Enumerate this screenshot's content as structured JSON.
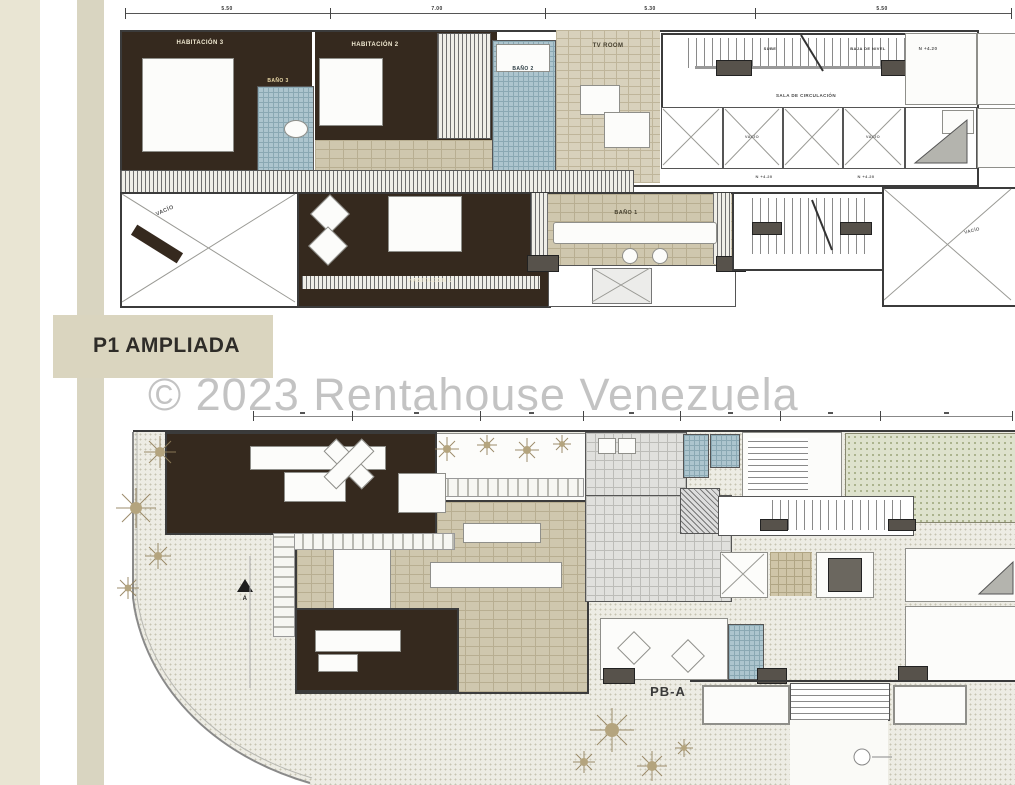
{
  "watermark": {
    "text": "© 2023 Rentahouse Venezuela"
  },
  "plan1": {
    "title": "P1 AMPLIADA",
    "dims": [
      "5.50",
      "7.00",
      "5.30",
      "5.50"
    ],
    "rooms": {
      "habitacion3": "HABITACIÓN 3",
      "bano3": "BAÑO 3",
      "habitacion2": "HABITACIÓN 2",
      "bano2": "BAÑO 2",
      "tvroom": "TV ROOM",
      "habitacion1": "HABITACIÓN 1",
      "bano1": "BAÑO 1",
      "sala_circulacion": "SALA DE CIRCULACIÓN",
      "vacio": "VACÍO"
    },
    "stairs": {
      "sube": "SUBE",
      "baja": "BAJA DE NIVEL"
    },
    "level": "N +4.20"
  },
  "plan2": {
    "title": "PB-A",
    "north_mark": "A"
  },
  "colors": {
    "dark_wood": "#35291e",
    "tile_beige": "#cfc7ae",
    "tile_blue": "#adc5ce",
    "sidebar_beige": "#e9e5d3",
    "title_block_beige": "#dad5bf",
    "watermark_gray": "#a0a0a0"
  }
}
